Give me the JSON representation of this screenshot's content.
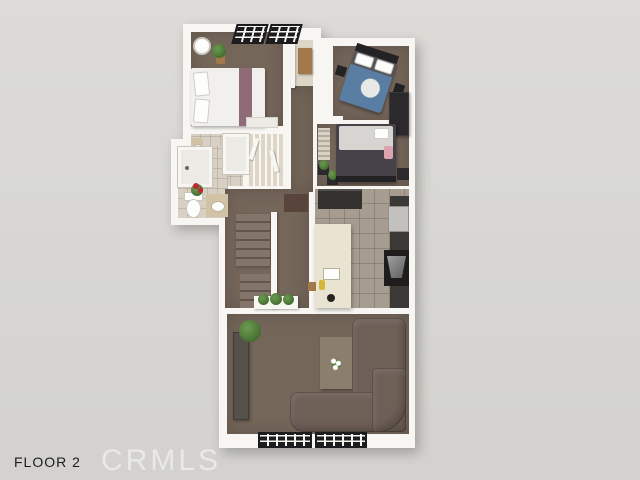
{
  "labels": {
    "floor": "FLOOR 2",
    "watermark": "CRMLS"
  },
  "colors": {
    "bg": "#dcdbd7",
    "bg2": "#d3d2ce",
    "wall": "#f7f6f2",
    "carpet": "#75665a",
    "bath_tile": "#d8d1c3",
    "closet_floor": "#ddd6c6",
    "kitchen_tile": "#a69c90",
    "island": "#e9e3d2",
    "cabinet_dark": "#34322f",
    "counter_dark": "#3b3936",
    "steel": "#c2c1bf",
    "stove": "#1e1d1c",
    "hood": "#9fa0a2",
    "sofa": "#6e5f57",
    "console": "#56504b",
    "table_wood": "#8b7e6d",
    "bed_white": "#f1f0ed",
    "mauve": "#8e6b77",
    "headboard_dark": "#232325",
    "duvet_blue": "#5a7da4",
    "duvet_gray": "#56555b",
    "bed_dark": "#454349",
    "duvet_light": "#d7d5d2",
    "pink": "#dba3ab",
    "wardrobe": "#2b292c",
    "wood": "#a3794c",
    "plant": "#4e7a38",
    "plant_dark": "#34552a",
    "flower_red": "#c1262e",
    "window_frame": "#1c1c1e",
    "vanity": "#d2c3a6",
    "rug": "#58443a",
    "stair_light": "#84756a",
    "stair_dark": "#60544b",
    "watermark": "rgba(255,255,255,0.5)",
    "text": "#1c1c1c"
  },
  "scene": {
    "type": "3d-floor-plan",
    "rooms": [
      "bedroom-1",
      "bedroom-2",
      "bedroom-2-sitting",
      "bathroom-1",
      "bathroom-2",
      "closet",
      "hallway",
      "stairs",
      "kitchen",
      "living-room"
    ]
  }
}
